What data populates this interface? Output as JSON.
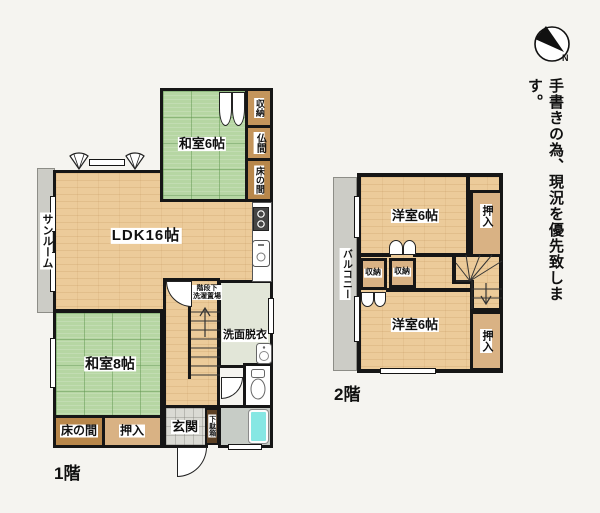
{
  "notice": "手書きの為、現況を優先致します。",
  "compass": {
    "north_label": "N"
  },
  "floor1": {
    "label": "1階",
    "sunroom": "サンルーム",
    "ldk": "LDK16帖",
    "washitsu6": "和室6帖",
    "shunou": "収納",
    "butsuma": "仏間",
    "tokonoma_upper": "床の間",
    "washitsu8": "和室8帖",
    "tokonoma_lower": "床の間",
    "oshiire": "押入",
    "genkan": "玄関",
    "getabako": "下駄箱",
    "under_stairs_line1": "階段下",
    "under_stairs_line2": "洗濯置場",
    "senmen": "洗面脱衣"
  },
  "floor2": {
    "label": "2階",
    "balcony": "バルコニー",
    "yoshitsu_upper": "洋室6帖",
    "oshiire_upper": "押入",
    "shunou_left": "収納",
    "shunou_right": "収納",
    "yoshitsu_lower": "洋室6帖",
    "oshiire_lower": "押入"
  },
  "colors": {
    "background": "#f5f4f0",
    "wall": "#161616",
    "tatami_green": "#b6d6a3",
    "wood_floor": "#eccb9a",
    "closet_tan": "#d9b284",
    "alcove_brown": "#c4955c",
    "shoe_cabinet_brown": "#5c4024",
    "sunroom_gray": "#ccccc6",
    "washroom_sage": "#e2e6d8",
    "bathtub_cyan": "#86e7e3",
    "entrance_tile": "#dadad4"
  }
}
